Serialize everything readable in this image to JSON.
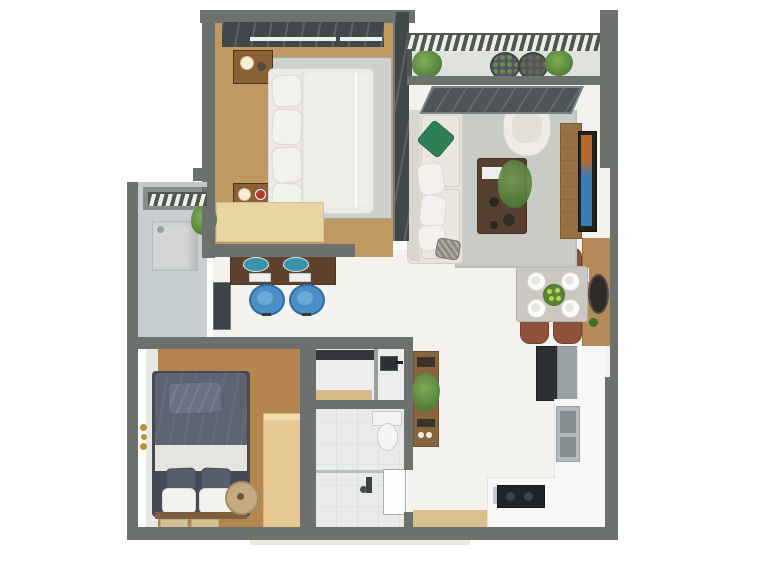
{
  "scene": {
    "description": "3D top-down architectural floor plan rendering of a small apartment with two bedrooms, living room, balcony, dining area, desk nook, utility balcony, bathroom and L-shaped kitchen",
    "image_type": "3d-floorplan-top-view",
    "background": "#ffffff"
  },
  "palette": {
    "bg": "#ffffff",
    "wall": "#6c716d",
    "wall_dark": "#51564f",
    "wall_light": "#c3c7c3",
    "wall_face": "#878d89",
    "glass_dark": "#41484a",
    "glass_frame": "#6d7a7e",
    "hall_floor": "#f3f2ee",
    "wood_br1": "#bf9962",
    "rug1": "#ced1cb",
    "rug1_dot": "#a4aaa3",
    "bench": "#e9d4a4",
    "bench_edge": "#d8c28c",
    "nightstand": "#8a6136",
    "lamp": "#f5efd8",
    "red_item": "#b5392c",
    "mattress": "#eceae5",
    "mattress_edge": "#d9d5cf",
    "pillow_white": "#f3f1ed",
    "pillow_edge": "#dcd8d2",
    "blanket": "#efede8",
    "desk": "#5e422d",
    "desk_edge": "#4d3423",
    "teal_bowl": "#3d93ac",
    "chair_blue": "#4a90c6",
    "chair_blue_dark": "#2f6da3",
    "keyboard": "#eef0ef",
    "window_dark": "#3d4346",
    "tile_utility": "#c7ced2",
    "tile_line": "#aeb8bd",
    "washer": "#d4d6d5",
    "washer_edge": "#b7bab8",
    "plant": "#5e9148",
    "plant_dark": "#3f6d2f",
    "plant_light": "#7fae55",
    "wood_br2": "#b5854f",
    "br2_edge": "#e8e8e5",
    "bed2_navy": "#5d6373",
    "bed2_pillow": "#6b7183",
    "bed2_dark_pillow": "#575d6a",
    "bed2_white": "#e7e5df",
    "bed2_frame": "#454a55",
    "bed2_foot": "#7d6040",
    "mat": "#d6c194",
    "mat_edge": "#c3ad7e",
    "wardrobe": "#e6c993",
    "wardrobe_line": "#d1b273",
    "basket": "#c4aa80",
    "basket_edge": "#a88c60",
    "basket_center": "#6b5636",
    "gold": "#bb9033",
    "bath_floor": "#eceeed",
    "bath_floor2": "#e9ebe9",
    "counter_dark": "#35363a",
    "shelf_wood": "#d9bb88",
    "fixture_white": "#f4f5f4",
    "fixture_border": "#c9cdcb",
    "door_white": "#fdfdfd",
    "door_border": "#a9aeaa",
    "shelf_unit": "#86653f",
    "slot_dark": "#3a3328",
    "kitchen_counter": "#f6f7f6",
    "counter_edge": "#e2e3e1",
    "fridge_dark": "#2c3033",
    "fridge_light": "#9aa1a4",
    "sink_steel": "#b3babd",
    "sink_bowl": "#878e91",
    "cooktop": "#222528",
    "steel_edge": "#c6c9cb",
    "table_top": "#cbc8c1",
    "table_edge": "#b3b0a9",
    "plate": "#fbfbfa",
    "plate_inner": "#e9e6e1",
    "salad": "#5c8437",
    "salad_dot": "#b8d24b",
    "chair_brown": "#8e523c",
    "chair_brown_dark": "#713f2d",
    "sideboard": "#b68a58",
    "sideboard_dark": "#97703f",
    "mirror_dark": "#2f2c28",
    "rug2": "#c8cbc6",
    "rug2_edge": "#bcbfba",
    "sofa": "#e6e3dc",
    "sofa_back": "#d9d6ce",
    "sofa_border": "#d3d0c7",
    "cushion": "#eae7e0",
    "pillow_green": "#2f7f56",
    "pillow_green_dark": "#256b47",
    "pillow_dark": "#8f8a7d",
    "armchair": "#efece6",
    "armchair_inner": "#e2dfd8",
    "ctable": "#56402f",
    "ctable_edge": "#463224",
    "bowl_dark": "#2b2723",
    "tv_wood": "#977044",
    "tv_wood_edge": "#7d5a34",
    "tv_frame": "#23211f",
    "tv_blue": "#3d7db2",
    "tv_orange": "#b9672f",
    "balcony_floor": "#dfe1dd",
    "pot_purple": "#585264",
    "pot_green": "#4e5b44",
    "wood_strip": "#d8c08f",
    "shadow_tan": "#efe9dd",
    "toilet_white": "#f2f3f2"
  },
  "rooms": [
    {
      "id": "bedroom-1",
      "furniture": [
        "double-bed",
        "pillows",
        "nightstand-top",
        "nightstand-bottom",
        "bench",
        "area-rug",
        "window"
      ]
    },
    {
      "id": "balcony",
      "furniture": [
        "railing",
        "potted-plants",
        "sliding-glass-door"
      ]
    },
    {
      "id": "living-room",
      "furniture": [
        "sofa",
        "coffee-table",
        "armchair",
        "area-rug",
        "tv-unit"
      ]
    },
    {
      "id": "dining-area",
      "furniture": [
        "dining-table",
        "four-chairs",
        "four-plates",
        "centerpiece",
        "sideboard",
        "mirror"
      ]
    },
    {
      "id": "desk-nook",
      "furniture": [
        "desk",
        "two-office-chairs",
        "two-keyboards",
        "window"
      ]
    },
    {
      "id": "utility-balcony",
      "furniture": [
        "washing-machine",
        "plant",
        "louver-screen"
      ]
    },
    {
      "id": "bedroom-2",
      "furniture": [
        "double-bed",
        "wardrobe",
        "round-basket",
        "floor-mats",
        "wall-decor"
      ]
    },
    {
      "id": "bathroom",
      "furniture": [
        "vanity-counter",
        "sink",
        "toilet",
        "shower",
        "door"
      ]
    },
    {
      "id": "kitchen",
      "furniture": [
        "fridge",
        "l-counter",
        "double-sink",
        "cooktop"
      ]
    },
    {
      "id": "hallway",
      "furniture": [
        "wood-threshold"
      ]
    }
  ]
}
